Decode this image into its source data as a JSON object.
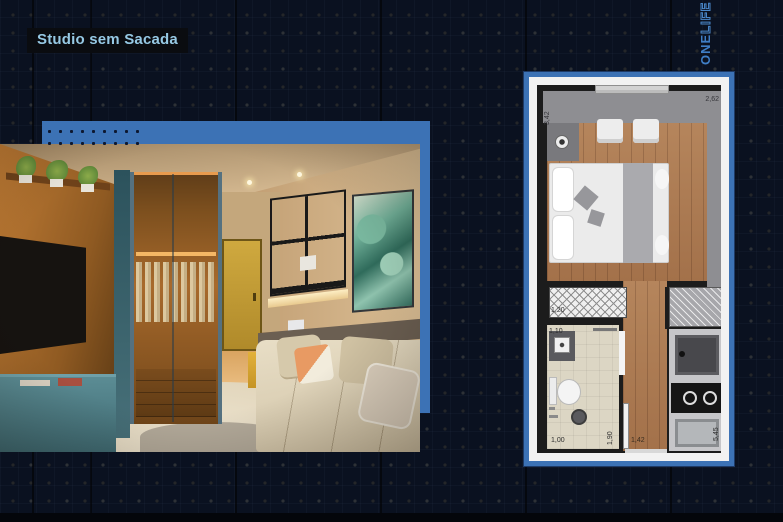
{
  "page": {
    "title": "Studio sem Sacada"
  },
  "logo": {
    "one": "ONE",
    "life": "LIFE"
  },
  "floor_plan": {
    "dims": {
      "room_width_top": "2,62",
      "room_length_left": "3,42",
      "wardrobe": "1,20",
      "bath_entry": "1,10",
      "bath_width": "1,00",
      "bath_length": "1,90",
      "hall": "1,42",
      "kitchen_side": "5,45"
    }
  },
  "palette": {
    "background": "#0a1120",
    "accent_blue": "#3c72b5",
    "title_bg": "#0a0c10",
    "title_text": "#96c9e4",
    "logo_blue": "#3f7ec6",
    "plan_wall": "#1c1c1c",
    "plan_wood": "#b5855c"
  }
}
